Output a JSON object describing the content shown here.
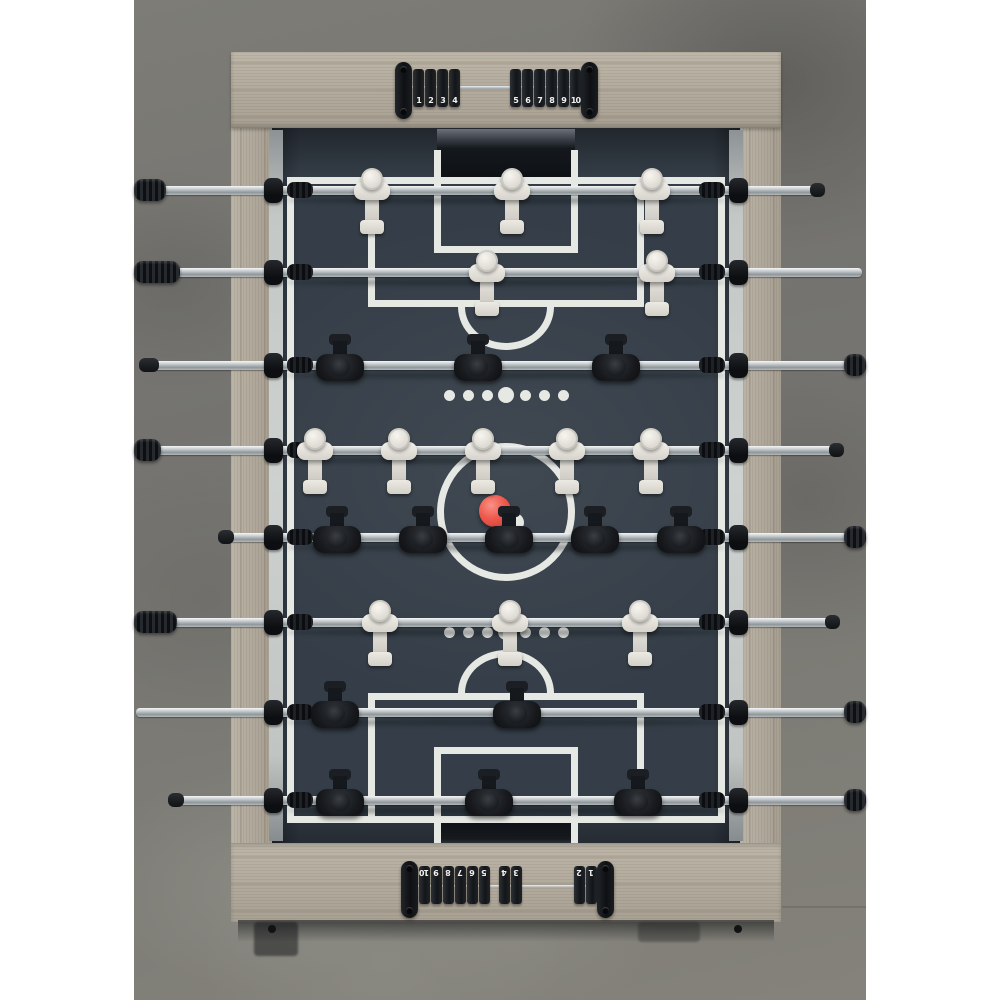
{
  "image": {
    "description": "Top-down product photo of a foosball table on a concrete floor",
    "colors": {
      "page_bg": "#ffffff",
      "concrete": "#7b7a74",
      "wood": "#b2aa9c",
      "pitch": "#353e48",
      "pitch_line": "#e6e8e4",
      "rod_silver": "#c9cdd0",
      "black_parts": "#15181c",
      "white_team": "#e8e6e0",
      "black_team": "#17191c",
      "ball": "#ee5a4d"
    }
  },
  "scoreboard_top": {
    "left_beads": [
      "1",
      "2",
      "3",
      "4"
    ],
    "right_beads": [
      "5",
      "6",
      "7",
      "8",
      "9",
      "10"
    ]
  },
  "scoreboard_bottom": {
    "groups": [
      [
        "10",
        "9",
        "8",
        "7",
        "6",
        "5"
      ],
      [
        "4",
        "3"
      ],
      [
        "2",
        "1"
      ]
    ]
  },
  "field": {
    "center_x": 506,
    "ball": {
      "cx": 495,
      "cy": 511,
      "r": 16
    },
    "center_spot": {
      "cx": 514,
      "cy": 521,
      "r": 9
    },
    "dot_rows": {
      "ys": [
        395,
        632
      ],
      "offsets": [
        -57,
        -38,
        -19,
        0,
        19,
        38,
        57
      ],
      "radii": [
        5.5,
        5.5,
        5.5,
        8,
        5.5,
        5.5,
        5.5
      ]
    }
  },
  "rods": [
    {
      "y": 190,
      "team": "white",
      "players": [
        372,
        512,
        652
      ],
      "bar": [
        135,
        825
      ],
      "left_grip": [
        134,
        166
      ],
      "right_grip": null,
      "left_cap": false,
      "right_cap": [
        810,
        825
      ]
    },
    {
      "y": 272,
      "team": "white",
      "players": [
        487,
        657
      ],
      "bar": [
        134,
        862
      ],
      "left_grip": [
        134,
        180
      ],
      "right_grip": null,
      "left_cap": false,
      "right_cap": false
    },
    {
      "y": 365,
      "team": "black",
      "players": [
        340,
        478,
        616
      ],
      "bar": [
        142,
        866
      ],
      "left_grip": null,
      "right_grip": [
        844,
        866
      ],
      "left_cap": [
        139,
        159
      ],
      "right_cap": false
    },
    {
      "y": 450,
      "team": "white",
      "players": [
        315,
        399,
        483,
        567,
        651
      ],
      "bar": [
        134,
        843
      ],
      "left_grip": [
        134,
        161
      ],
      "right_grip": null,
      "left_cap": false,
      "right_cap": [
        829,
        844
      ]
    },
    {
      "y": 537,
      "team": "black",
      "players": [
        337,
        423,
        509,
        595,
        681
      ],
      "bar": [
        221,
        866
      ],
      "left_grip": null,
      "right_grip": [
        844,
        866
      ],
      "left_cap": [
        218,
        234
      ],
      "right_cap": false
    },
    {
      "y": 622,
      "team": "white",
      "players": [
        380,
        510,
        640
      ],
      "bar": [
        134,
        839
      ],
      "left_grip": [
        134,
        177
      ],
      "right_grip": null,
      "left_cap": false,
      "right_cap": [
        825,
        840
      ]
    },
    {
      "y": 712,
      "team": "black",
      "players": [
        335,
        517
      ],
      "bar": [
        136,
        866
      ],
      "left_grip": null,
      "right_grip": [
        844,
        866
      ],
      "left_cap": false,
      "right_cap": false
    },
    {
      "y": 800,
      "team": "black",
      "players": [
        340,
        489,
        638
      ],
      "bar": [
        171,
        866
      ],
      "left_grip": null,
      "right_grip": [
        844,
        866
      ],
      "left_cap": [
        168,
        184
      ],
      "right_cap": false
    }
  ]
}
